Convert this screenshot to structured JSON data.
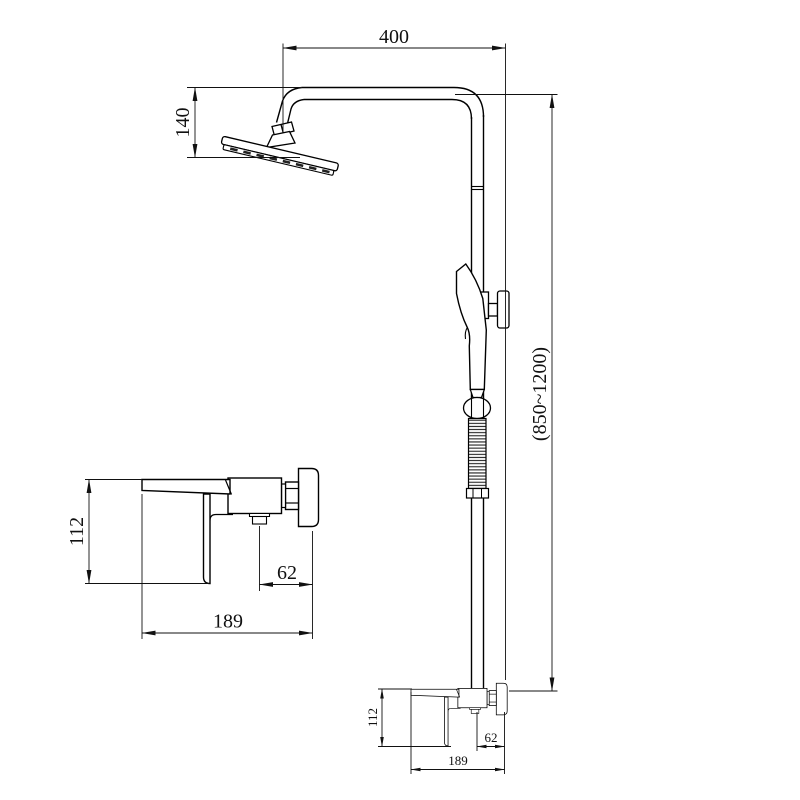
{
  "colors": {
    "background": "#ffffff",
    "ink": "#000000"
  },
  "main_view": {
    "arm_reach": "400",
    "head_drop": "140",
    "riser_height": "(850~1200)",
    "mixer_height": "112",
    "mixer_outlet_offset": "62",
    "mixer_width": "189"
  },
  "detail_view": {
    "mixer_height": "112",
    "mixer_outlet_offset": "62",
    "mixer_width": "189"
  }
}
